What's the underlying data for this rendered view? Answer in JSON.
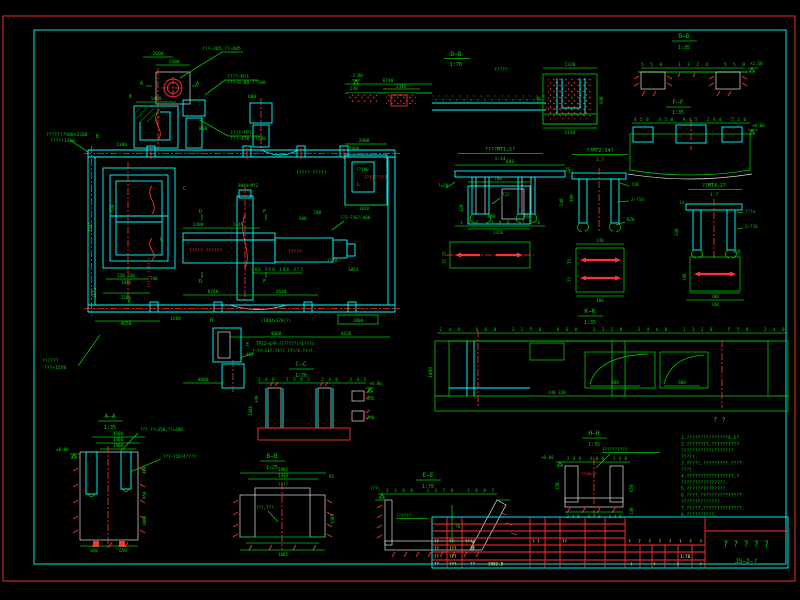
{
  "canvas": {
    "width": 800,
    "height": 600,
    "bg": "#000000"
  },
  "palette": {
    "green": "#00c800",
    "cyan": "#00ffff",
    "red": "#ff3232",
    "yellow": "#ffff66",
    "white": "#e8e8e8"
  },
  "plan": {
    "leaders": {
      "top": "???—305,??—405",
      "mt1a": "????—M?1",
      "mt1b": "???+0.00 ??500",
      "mt2a": "????—M?1",
      "mt2b": "???—450 ??500",
      "left1": "???????500×2200",
      "left2": "????+1350",
      "bl1": "??????",
      "bl2": "???+1550",
      "anchor": "??2—?16?—400",
      "m9044": "9044—M?2",
      "tp1": "TP12—4/R-???????(?1???)",
      "tp2": "?—??—11?,?4??,???/4,??~?",
      "pair": "????? ?????",
      "right_red": "?????????",
      "pit100": "??100"
    },
    "red_labels": {
      "box1": "????? ??????",
      "box2": "?????",
      "vert": "????? ??????"
    },
    "marks": {
      "a1": "A",
      "a2": "A",
      "k1": "K",
      "k2": "K",
      "b": "B",
      "c": "C",
      "d1": "D",
      "d2": "D",
      "f1": "F",
      "f2": "F",
      "g": "G",
      "h": "H",
      "e": "E",
      "l": "L"
    },
    "dims": {
      "d2600": "2600",
      "d1500": "1500",
      "d1400t": "1400",
      "d800": "800",
      "d1300": "1300",
      "d680": "680",
      "d2000": "2000",
      "d1400r": "1400",
      "d1020": "1020",
      "v4581": "4581",
      "v1572": "1572",
      "v530": "530",
      "d220": "220 220",
      "d1046": "1046",
      "d2106": "2106",
      "d700l": "700",
      "d4650": "4650",
      "d1200": "1200",
      "d1400m": "1400",
      "d1449": "1449",
      "d700m": "700",
      "d400": "400",
      "chain_mid": "480 958 108 375",
      "d8748": "8748",
      "d2640": "2640",
      "d1320": "1320",
      "d1054": "1054",
      "note1884": "(1884×370(?)",
      "d1800": "1800",
      "d4060": "4060",
      "d4436": "4436",
      "d4000": "4000",
      "d1320p": "1320",
      "d320p": "320",
      "d700p": "700",
      "d463": "463"
    }
  },
  "views": {
    "db": {
      "title": "D—B",
      "scale": "1:70",
      "level": "-2.00",
      "label": "?????",
      "red_label": "????????",
      "dims": {
        "top": "8748",
        "s2446": "2446",
        "s240": "240",
        "w1320": "1320",
        "v240": "240",
        "v940": "940",
        "bottom": "2146"
      }
    },
    "dd": {
      "title": "D—D",
      "scale": "1:35",
      "level": "+2.50",
      "chain": "550   1324   550"
    },
    "ff": {
      "title": "F—F",
      "scale": "1:35",
      "level": "+0.60",
      "chain": "450 450 945 240 520"
    },
    "mt1": {
      "title": "????MT1,5?",
      "scale": "1:14",
      "dims": {
        "top": "680",
        "r15": "15",
        "r400": "400",
        "a50": "?=50",
        "r50": "R50",
        "r60": "R60",
        "f22": "?22",
        "bottom": "100  300  300",
        "side": "75 75"
      }
    },
    "mt2": {
      "title": "??MT2,14?",
      "scale": "1:7",
      "dims": {
        "t25": "25",
        "v240": "240",
        "f20": "?20",
        "bolts": "2—?16",
        "r20": "R20",
        "p140": "140",
        "p75a": "75",
        "p75b": "75",
        "p180": "180"
      }
    },
    "mt4": {
      "title": "??MT4,2?",
      "scale": "1:7",
      "dims": {
        "t14": "14",
        "v240": "240",
        "fa": "???a",
        "bolts": "2—?16",
        "r20": "R20",
        "p200": "200",
        "p348": "348",
        "v190": "190"
      }
    },
    "kk": {
      "title": "K—K",
      "scale": "1:35",
      "chain": "240 600 3250 860 1320 2448 1320 550 240",
      "v1400": "1400",
      "d480": "480",
      "d680": "680",
      "sub": "240  320"
    },
    "cc": {
      "title": "C—C",
      "scale": "1:70",
      "level": "+0.00",
      "chain": "240  1505  240  345",
      "v1406": "1406",
      "v340": "340",
      "r345": "345",
      "r240": "240"
    },
    "aa": {
      "title": "A—A",
      "scale": "1:35",
      "level": "±0.00",
      "t1": "4500",
      "t2": "1400",
      "t3": "1900",
      "r1": "450",
      "r2": "950",
      "r3": "1060",
      "b1": "650",
      "b2": "650",
      "lead1": "??? ??=350,??=400",
      "lead2": "???—?16?4????"
    },
    "bb": {
      "title": "B—B",
      "scale": "1:25",
      "d1885": "1885",
      "d1444": "1444",
      "glab": "????",
      "lead": "???,???",
      "r85": "85",
      "r1400": "1400",
      "bottom": "1885"
    },
    "ee": {
      "title": "E—E",
      "scale": "1:70",
      "chain": "1300   1378   1085",
      "lab": "??????",
      "d50": "?0",
      "lv": "(??)"
    },
    "hh": {
      "title": "H—H",
      "scale": "1:35",
      "level": "+0.60",
      "lead": "??????????",
      "red": "??20×4?",
      "chain": "240  600  240",
      "r650": "650",
      "r130": "130",
      "l150": "150",
      "bottom": "240  640  240"
    }
  },
  "notes": {
    "title": "?    ?",
    "lines": [
      "1.???????????????4.5?.",
      "2.????????,??????????",
      "  ???????????(???????",
      "  ????).",
      "3.????(,?????????,????",
      "  ???).",
      "4.?????????????????,?",
      "  ????????????????.",
      "5.??????????????.",
      "6.????,???????????????",
      "  ??????????????.",
      "7.??/??,??????????????.",
      "8.??????????."
    ]
  },
  "titleblock": {
    "row1": [
      "??",
      "??",
      "????",
      "?  ?",
      "??"
    ],
    "row2": [
      "??",
      "???",
      "??"
    ],
    "row3": [
      "??",
      "???"
    ],
    "row4": [
      "??",
      "???",
      "??",
      "2002.8"
    ],
    "header": "?  ?  ?  ?    ?  ?    ?  ?",
    "footer": "?      ?      ?      ?",
    "scale": "1:70",
    "title": "?  ?  ?  ?  ?",
    "number": "JS—2—?"
  }
}
